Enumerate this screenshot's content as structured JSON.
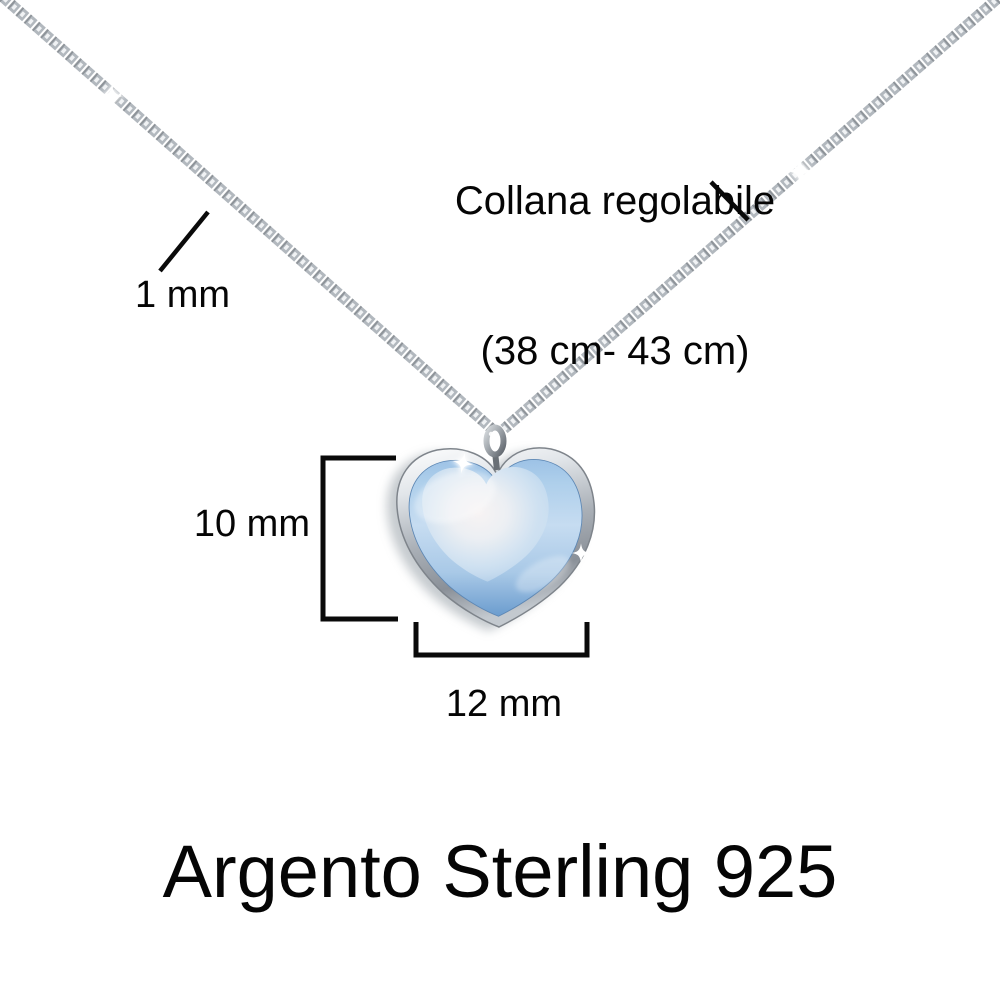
{
  "annotations": {
    "chain_note": {
      "line1": "Collana regolabile",
      "line2": "(38 cm- 43 cm)"
    },
    "chain_thickness": "1 mm",
    "pendant_height": "10 mm",
    "pendant_width": "12 mm"
  },
  "caption": {
    "material": "Argento Sterling 925"
  },
  "illustration": {
    "subject": "silver box-chain necklace with light-blue heart pendant",
    "colors": {
      "background": "#ffffff",
      "text": "#050505",
      "measure_lines": "#0a0a0a",
      "chain_silver": "#b2b8be",
      "chain_dark": "#83898f",
      "bezel_light": "#f4f6f8",
      "bezel_mid": "#aab0b7",
      "bezel_dark": "#8a9098",
      "stone_light": "#c6dcf1",
      "stone_mid": "#a7c9e9",
      "stone_deep": "#6b9cce",
      "stone_sheen": "#f7f3f3"
    }
  }
}
